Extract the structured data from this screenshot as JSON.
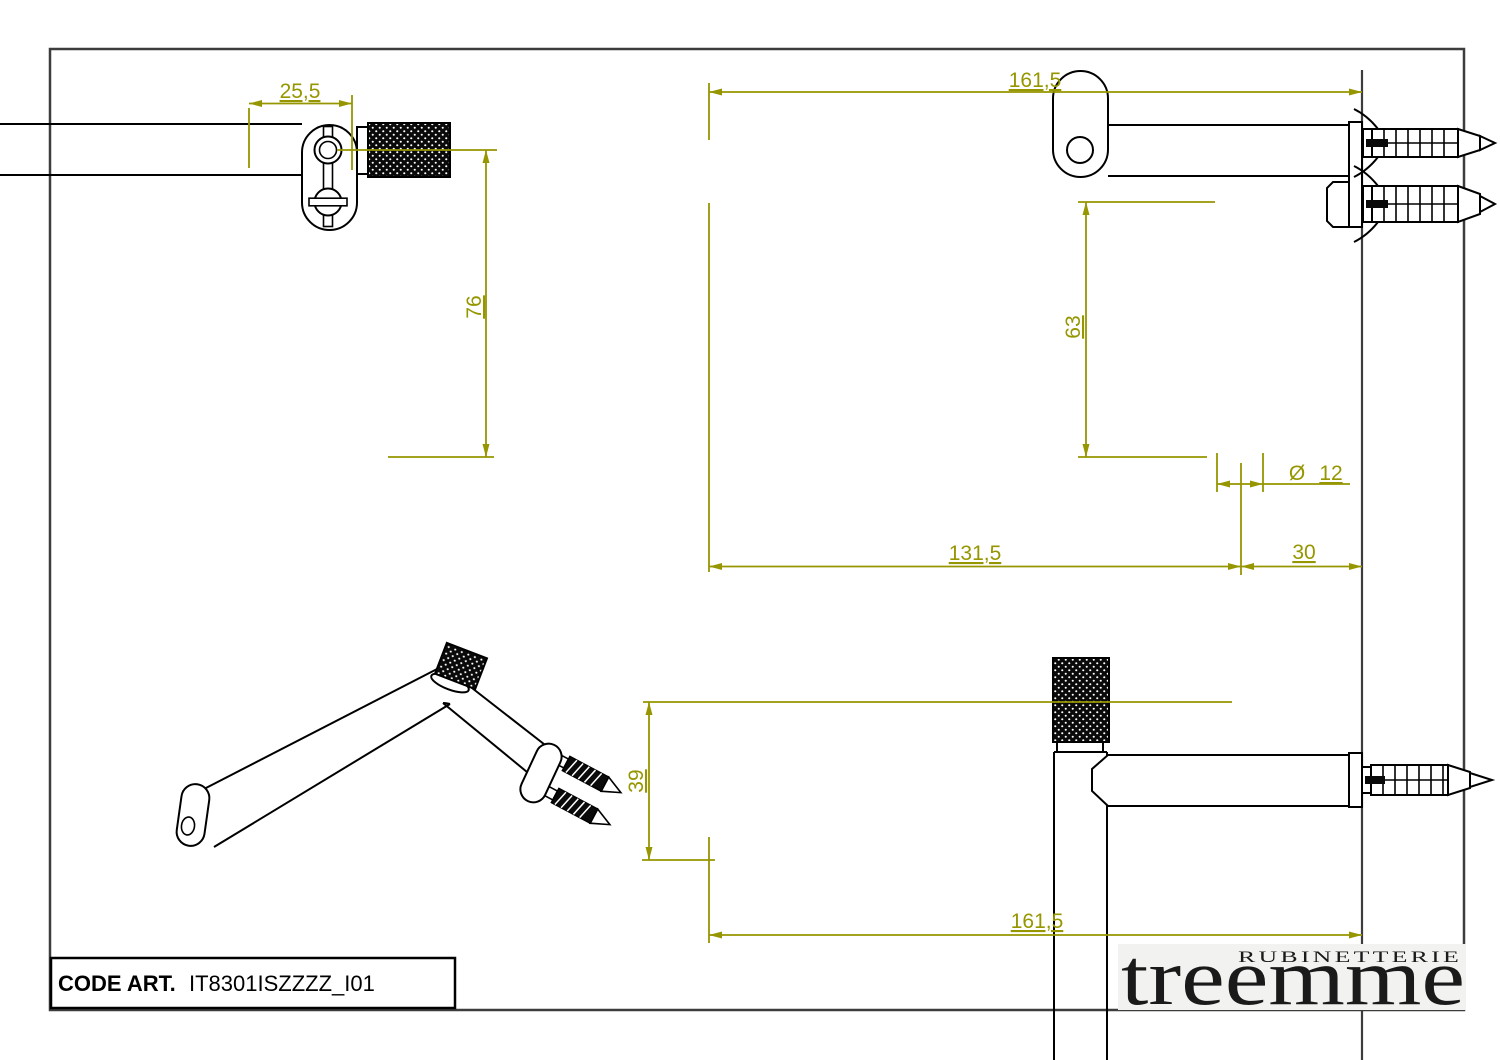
{
  "drawing": {
    "title_block": {
      "code_label": "CODE ART.",
      "code_value": "IT8301ISZZZZ_I01"
    },
    "logo": {
      "tagline": "RUBINETTERIE",
      "brand": "treemme"
    },
    "dimensions": {
      "front_width": "25,5",
      "front_drop": "76",
      "side_total": "161,5",
      "side_height": "63",
      "dia_symbol": "Ø",
      "dia_value": "12",
      "side_inner": "131,5",
      "wall_depth": "30",
      "plan_offset": "39",
      "plan_total": "161,5"
    },
    "colors": {
      "dimension": "#969600",
      "outline": "#000000",
      "frame": "#3d3d3d",
      "logo_ink": "#1a1a1a"
    }
  }
}
